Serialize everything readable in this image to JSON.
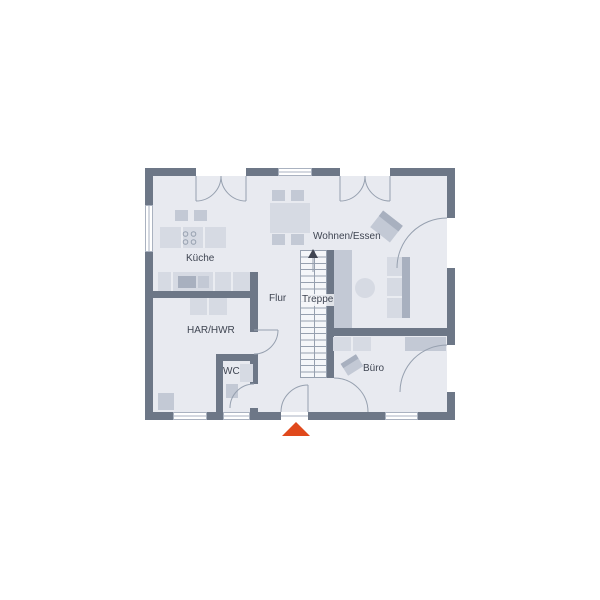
{
  "plan": {
    "type": "floor-plan",
    "floor_name": "Erdgeschoss"
  },
  "rooms": {
    "kueche": {
      "label": "Küche"
    },
    "wohnen_essen": {
      "label": "Wohnen/Essen"
    },
    "flur": {
      "label": "Flur"
    },
    "treppe": {
      "label": "Treppe"
    },
    "har_hwr": {
      "label": "HAR/HWR"
    },
    "wc": {
      "label": "WC"
    },
    "buero": {
      "label": "Büro"
    }
  },
  "markers": {
    "entrance": {
      "shape": "triangle-up",
      "color": "#e0491c"
    }
  },
  "colors": {
    "wall": "#6d7787",
    "floor": "#e8eaf0",
    "furniture_light": "#d6dae3",
    "furniture_mid": "#c3c9d5",
    "furniture_dark": "#a8b0bf",
    "outline": "#96a0af",
    "frame": "#aab2c0",
    "stairs_bg": "#f4f6f9",
    "label": "#3f4552",
    "accent": "#e0491c"
  }
}
